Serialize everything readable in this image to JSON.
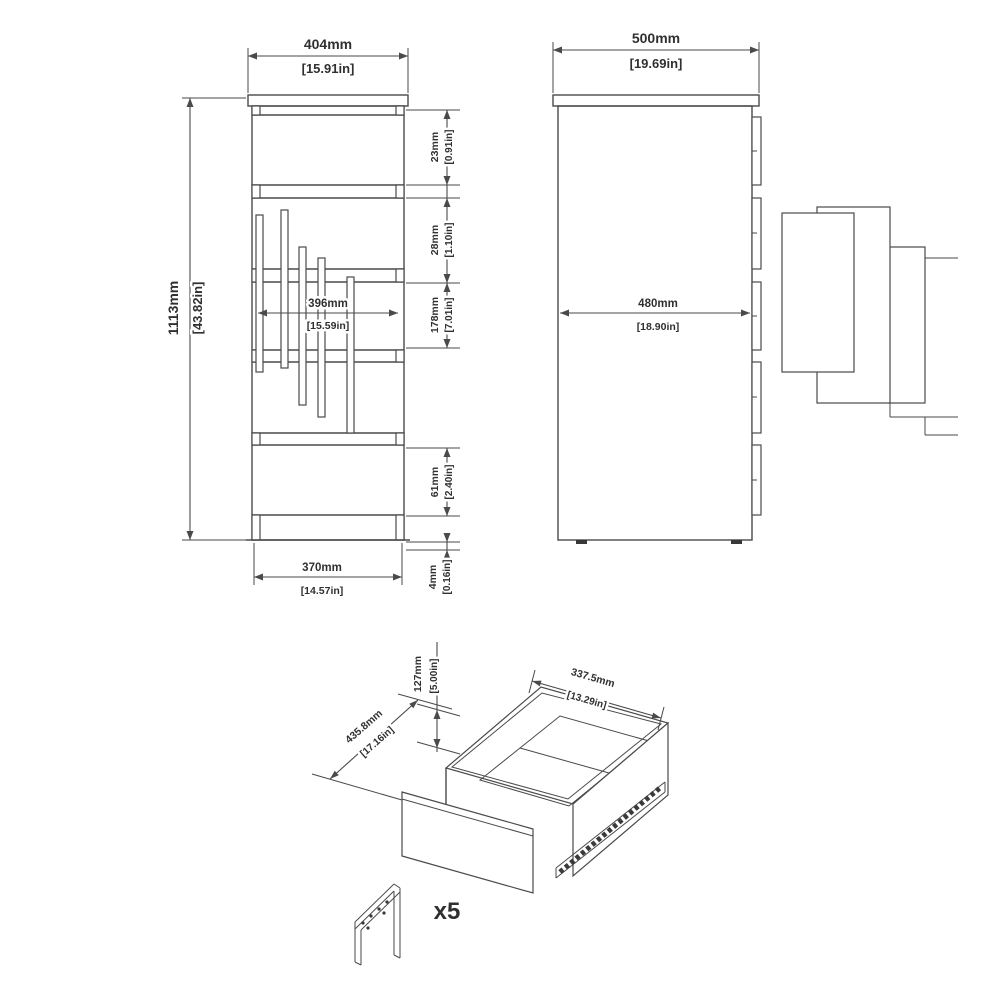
{
  "views": {
    "front": {
      "dim_width": {
        "mm": "404mm",
        "in": "[15.91in]"
      },
      "dim_height": {
        "mm": "1113mm",
        "in": "[43.82in]"
      },
      "dim_handle_width": {
        "mm": "396mm",
        "in": "[15.59in]"
      },
      "dim_base_width": {
        "mm": "370mm",
        "in": "[14.57in]"
      },
      "dim_top_section": {
        "mm": "23mm",
        "in": "[0.91in]"
      },
      "dim_gap_section": {
        "mm": "28mm",
        "in": "[1.10in]"
      },
      "dim_drawer_front": {
        "mm": "178mm",
        "in": "[7.01in]"
      },
      "dim_plinth": {
        "mm": "61mm",
        "in": "[2.40in]"
      },
      "dim_foot": {
        "mm": "4mm",
        "in": "[0.16in]"
      }
    },
    "side": {
      "dim_depth": {
        "mm": "500mm",
        "in": "[19.69in]"
      },
      "dim_inner_depth": {
        "mm": "480mm",
        "in": "[18.90in]"
      }
    },
    "drawer": {
      "dim_height": {
        "mm": "127mm",
        "in": "[5.00in]"
      },
      "dim_depth": {
        "mm": "435.8mm",
        "in": "[17.16in]"
      },
      "dim_width": {
        "mm": "337.5mm",
        "in": "[13.29in]"
      }
    }
  },
  "hardware": {
    "quantity_label": "x5"
  },
  "colors": {
    "line": "#4a4a4a",
    "text": "#303030",
    "background": "#ffffff"
  }
}
